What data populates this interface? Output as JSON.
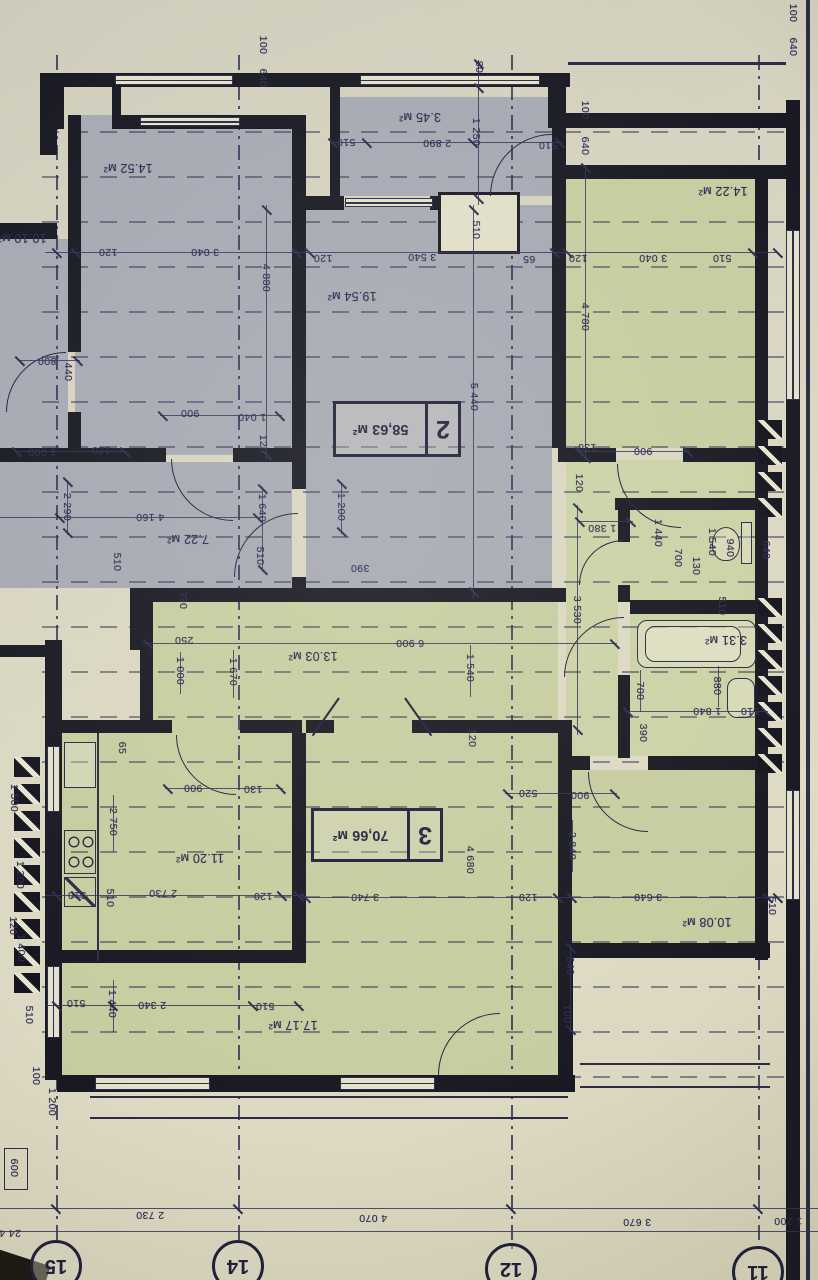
{
  "title": "apartment floor plan photo (rotated 180°)",
  "palette": {
    "paper": "#d8d5c1",
    "ink": "#2d2d52",
    "wall": "#191923",
    "gray_room": "#a7a9b3",
    "green_room": "#c7cda0"
  },
  "stamps": [
    {
      "num": "2",
      "area": "58,63 м²",
      "box": [
        333,
        401,
        122,
        50
      ]
    },
    {
      "num": "3",
      "area": "70,66 м²",
      "box": [
        311,
        808,
        126,
        48
      ]
    }
  ],
  "axes": [
    {
      "label": "15",
      "x": 56,
      "y": 1266
    },
    {
      "label": "14",
      "x": 238,
      "y": 1266
    },
    {
      "label": "12",
      "x": 511,
      "y": 1269
    },
    {
      "label": "11",
      "x": 758,
      "y": 1272
    }
  ],
  "rooms": [
    {
      "c": "gray",
      "r": [
        75,
        115,
        217,
        340
      ]
    },
    {
      "c": "gray",
      "r": [
        0,
        239,
        68,
        210
      ]
    },
    {
      "c": "gray",
      "r": [
        0,
        462,
        292,
        126
      ]
    },
    {
      "c": "gray",
      "r": [
        306,
        205,
        246,
        383
      ]
    },
    {
      "c": "gray",
      "r": [
        340,
        97,
        215,
        99
      ]
    },
    {
      "c": "green",
      "r": [
        566,
        179,
        189,
        269
      ]
    },
    {
      "c": "green2",
      "r": [
        566,
        460,
        190,
        140
      ]
    },
    {
      "c": "green2",
      "r": [
        630,
        510,
        125,
        90
      ]
    },
    {
      "c": "green2",
      "r": [
        630,
        614,
        125,
        142
      ]
    },
    {
      "c": "green",
      "r": [
        153,
        602,
        405,
        131
      ]
    },
    {
      "c": "green2",
      "r": [
        566,
        600,
        52,
        156
      ]
    },
    {
      "c": "green",
      "r": [
        62,
        733,
        230,
        217
      ]
    },
    {
      "c": "green",
      "r": [
        306,
        733,
        252,
        230
      ]
    },
    {
      "c": "green",
      "r": [
        62,
        963,
        496,
        112
      ]
    },
    {
      "c": "green",
      "r": [
        572,
        770,
        183,
        173
      ]
    }
  ],
  "walls": [
    [
      40,
      73,
      530,
      14
    ],
    [
      548,
      73,
      16,
      50
    ],
    [
      548,
      113,
      240,
      15
    ],
    [
      558,
      165,
      230,
      14
    ],
    [
      55,
      87,
      9,
      42
    ],
    [
      112,
      87,
      9,
      42
    ],
    [
      118,
      115,
      186,
      14
    ],
    [
      68,
      115,
      13,
      237
    ],
    [
      68,
      412,
      13,
      43
    ],
    [
      0,
      223,
      57,
      16
    ],
    [
      292,
      115,
      14,
      374
    ],
    [
      292,
      577,
      14,
      25
    ],
    [
      330,
      87,
      10,
      112
    ],
    [
      552,
      87,
      14,
      110
    ],
    [
      302,
      196,
      42,
      14
    ],
    [
      430,
      196,
      12,
      14
    ],
    [
      0,
      448,
      166,
      14
    ],
    [
      233,
      448,
      60,
      14
    ],
    [
      558,
      448,
      58,
      14
    ],
    [
      683,
      448,
      104,
      14
    ],
    [
      552,
      127,
      14,
      321
    ],
    [
      130,
      588,
      436,
      14
    ],
    [
      130,
      588,
      13,
      62
    ],
    [
      140,
      595,
      13,
      138
    ],
    [
      0,
      645,
      47,
      12
    ],
    [
      45,
      640,
      17,
      62
    ],
    [
      62,
      720,
      110,
      13
    ],
    [
      240,
      720,
      62,
      13
    ],
    [
      292,
      733,
      14,
      217
    ],
    [
      62,
      950,
      244,
      13
    ],
    [
      306,
      720,
      28,
      13
    ],
    [
      412,
      720,
      153,
      13
    ],
    [
      558,
      720,
      14,
      240
    ],
    [
      615,
      498,
      145,
      12
    ],
    [
      618,
      510,
      12,
      32
    ],
    [
      618,
      585,
      12,
      17
    ],
    [
      630,
      600,
      128,
      14
    ],
    [
      618,
      675,
      12,
      83
    ],
    [
      572,
      756,
      18,
      14
    ],
    [
      648,
      756,
      120,
      14
    ],
    [
      755,
      165,
      13,
      293
    ],
    [
      755,
      448,
      13,
      512
    ],
    [
      786,
      100,
      14,
      1180
    ],
    [
      57,
      1075,
      518,
      17
    ],
    [
      558,
      958,
      15,
      130
    ],
    [
      572,
      943,
      198,
      15
    ],
    [
      40,
      73,
      17,
      82
    ],
    [
      45,
      700,
      17,
      380
    ]
  ],
  "windows": [
    [
      115,
      75,
      118,
      10,
      "h"
    ],
    [
      140,
      117,
      100,
      9,
      "h"
    ],
    [
      345,
      198,
      88,
      9,
      "h"
    ],
    [
      360,
      75,
      180,
      10,
      "h"
    ],
    [
      786,
      230,
      14,
      170,
      "v"
    ],
    [
      786,
      790,
      14,
      110,
      "v"
    ],
    [
      47,
      746,
      13,
      66,
      "v"
    ],
    [
      47,
      966,
      13,
      72,
      "v"
    ],
    [
      95,
      1077,
      115,
      13,
      "h"
    ],
    [
      340,
      1077,
      95,
      13,
      "h"
    ]
  ],
  "chimney": [
    438,
    192,
    82,
    62
  ],
  "thin": [
    [
      97,
      733,
      2,
      228
    ],
    [
      568,
      62,
      218,
      3
    ],
    [
      806,
      0,
      4,
      1280
    ],
    [
      90,
      1096,
      478,
      2
    ],
    [
      90,
      1117,
      478,
      2
    ],
    [
      580,
      1063,
      190,
      2
    ],
    [
      580,
      1086,
      190,
      2
    ]
  ],
  "detail_box": [
    4,
    1148,
    24,
    42
  ],
  "vents": [
    {
      "x": 14,
      "y": 757,
      "n": 9,
      "step": 27,
      "w": 26,
      "h": 20
    },
    {
      "x": 758,
      "y": 420,
      "n": 4,
      "step": 26,
      "w": 24,
      "h": 19
    },
    {
      "x": 758,
      "y": 598,
      "n": 7,
      "step": 26,
      "w": 24,
      "h": 19
    }
  ],
  "doors": [
    [
      171,
      459,
      62,
      "bl"
    ],
    [
      6,
      352,
      60,
      "tl"
    ],
    [
      234,
      513,
      64,
      "tl"
    ],
    [
      490,
      134,
      62,
      "tl"
    ],
    [
      617,
      464,
      64,
      "bl"
    ],
    [
      176,
      735,
      60,
      "bl"
    ],
    [
      564,
      617,
      60,
      "tl"
    ],
    [
      579,
      540,
      45,
      "tl"
    ],
    [
      588,
      772,
      60,
      "bl"
    ],
    [
      438,
      1013,
      62,
      "tl"
    ]
  ],
  "leaves": [
    [
      338,
      698,
      46,
      35
    ],
    [
      404,
      698,
      46,
      -35
    ]
  ],
  "fixtures": {
    "tub": [
      637,
      620,
      119,
      48
    ],
    "tub_inner": [
      645,
      626,
      96,
      36
    ],
    "bath_sink": [
      727,
      678,
      28,
      40
    ],
    "toilet_bowl": [
      712,
      527,
      28,
      34
    ],
    "toilet_tank": [
      741,
      522,
      11,
      42
    ],
    "kitchen_sink": [
      64,
      742,
      32,
      46
    ],
    "kitchen_stove": [
      64,
      830,
      32,
      44
    ],
    "kitchen_wash": [
      64,
      877,
      32,
      30
    ]
  },
  "dimlines": [
    {
      "o": "h",
      "x": 45,
      "y": 252,
      "len": 733,
      "ticks": [
        57,
        76,
        297,
        310,
        555,
        568,
        753,
        778
      ]
    },
    {
      "o": "h",
      "x": 330,
      "y": 142,
      "len": 233,
      "ticks": [
        333,
        367,
        473,
        560
      ]
    },
    {
      "o": "v",
      "x": 478,
      "y": 60,
      "len": 145,
      "ticks": [
        64,
        88,
        199
      ]
    },
    {
      "o": "v",
      "x": 473,
      "y": 205,
      "len": 393,
      "ticks": [
        210,
        592
      ]
    },
    {
      "o": "v",
      "x": 266,
      "y": 205,
      "len": 255,
      "ticks": [
        210,
        455
      ]
    },
    {
      "o": "v",
      "x": 585,
      "y": 165,
      "len": 295,
      "ticks": [
        168,
        458
      ]
    },
    {
      "o": "h",
      "x": 18,
      "y": 360,
      "len": 62,
      "ticks": [
        20,
        78
      ]
    },
    {
      "o": "h",
      "x": 160,
      "y": 415,
      "len": 122,
      "ticks": [
        163,
        280
      ]
    },
    {
      "o": "h",
      "x": 15,
      "y": 451,
      "len": 112,
      "ticks": [
        17,
        125
      ]
    },
    {
      "o": "h",
      "x": 577,
      "y": 451,
      "len": 113,
      "ticks": [
        580,
        688
      ]
    },
    {
      "o": "h",
      "x": 0,
      "y": 517,
      "len": 262,
      "ticks": [
        60,
        258
      ]
    },
    {
      "o": "v",
      "x": 67,
      "y": 480,
      "len": 55,
      "ticks": [
        482,
        533
      ]
    },
    {
      "o": "v",
      "x": 262,
      "y": 487,
      "len": 85,
      "ticks": [
        489,
        570
      ]
    },
    {
      "o": "v",
      "x": 341,
      "y": 482,
      "len": 52,
      "ticks": [
        484,
        532
      ]
    },
    {
      "o": "v",
      "x": 577,
      "y": 505,
      "len": 230,
      "ticks": [
        508,
        730
      ]
    },
    {
      "o": "h",
      "x": 578,
      "y": 521,
      "len": 55,
      "ticks": [
        580,
        631
      ]
    },
    {
      "o": "h",
      "x": 145,
      "y": 643,
      "len": 472,
      "ticks": [
        148,
        615
      ]
    },
    {
      "o": "v",
      "x": 180,
      "y": 652,
      "len": 42,
      "ticks": []
    },
    {
      "o": "v",
      "x": 233,
      "y": 650,
      "len": 48,
      "ticks": []
    },
    {
      "o": "v",
      "x": 470,
      "y": 645,
      "len": 52,
      "ticks": []
    },
    {
      "o": "v",
      "x": 113,
      "y": 795,
      "len": 57,
      "ticks": []
    },
    {
      "o": "h",
      "x": 165,
      "y": 788,
      "len": 118,
      "ticks": [
        168,
        281
      ]
    },
    {
      "o": "h",
      "x": 45,
      "y": 895,
      "len": 257,
      "ticks": [
        57,
        76,
        282,
        299
      ]
    },
    {
      "o": "h",
      "x": 505,
      "y": 793,
      "len": 112,
      "ticks": [
        508,
        615
      ]
    },
    {
      "o": "v",
      "x": 572,
      "y": 820,
      "len": 52,
      "ticks": []
    },
    {
      "o": "h",
      "x": 300,
      "y": 897,
      "len": 478,
      "ticks": [
        306,
        558,
        572,
        768,
        778
      ]
    },
    {
      "o": "h",
      "x": 45,
      "y": 1005,
      "len": 257,
      "ticks": [
        57,
        113,
        253,
        299
      ]
    },
    {
      "o": "v",
      "x": 113,
      "y": 980,
      "len": 52,
      "ticks": []
    },
    {
      "o": "v",
      "x": 570,
      "y": 945,
      "len": 87,
      "ticks": [
        948,
        1030
      ]
    },
    {
      "o": "h",
      "x": 625,
      "y": 711,
      "len": 143,
      "ticks": [
        628,
        766
      ]
    },
    {
      "o": "v",
      "x": 640,
      "y": 670,
      "len": 42,
      "ticks": []
    },
    {
      "o": "v",
      "x": 718,
      "y": 666,
      "len": 41,
      "ticks": []
    },
    {
      "o": "h",
      "x": 0,
      "y": 1208,
      "len": 818,
      "ticks": [
        56,
        238,
        511,
        758
      ]
    },
    {
      "o": "h",
      "x": 0,
      "y": 1231,
      "len": 818,
      "ticks": []
    }
  ],
  "dash_axes": [
    [
      56,
      55,
      1190
    ],
    [
      238,
      55,
      1190
    ],
    [
      511,
      55,
      1195
    ],
    [
      758,
      55,
      1200
    ]
  ],
  "labels": [
    [
      "100",
      263,
      45,
      90
    ],
    [
      "640",
      263,
      78,
      90
    ],
    [
      "80",
      479,
      67,
      90
    ],
    [
      "3.45 м²",
      420,
      117,
      180,
      1
    ],
    [
      "510",
      346,
      142,
      180
    ],
    [
      "2 890",
      437,
      143,
      180
    ],
    [
      "1 250",
      476,
      132,
      90
    ],
    [
      "510",
      548,
      145,
      180
    ],
    [
      "100",
      585,
      110,
      90
    ],
    [
      "640",
      585,
      146,
      90
    ],
    [
      "100",
      793,
      13,
      90
    ],
    [
      "640",
      793,
      47,
      90
    ],
    [
      "14.52 м²",
      128,
      168,
      180,
      1
    ],
    [
      "10.10 м²",
      22,
      238,
      180,
      1
    ],
    [
      "19.54 м²",
      352,
      296,
      180,
      1
    ],
    [
      "14.22 м²",
      723,
      191,
      180,
      1
    ],
    [
      "120",
      108,
      252,
      180
    ],
    [
      "3 040",
      205,
      252,
      180
    ],
    [
      "120",
      323,
      258,
      180
    ],
    [
      "3 540",
      422,
      257,
      180
    ],
    [
      "65",
      529,
      259,
      180
    ],
    [
      "120",
      578,
      258,
      180
    ],
    [
      "3 040",
      653,
      258,
      180
    ],
    [
      "510",
      722,
      258,
      180
    ],
    [
      "4 880",
      266,
      278,
      90
    ],
    [
      "510",
      476,
      230,
      90
    ],
    [
      "5 440",
      474,
      397,
      90
    ],
    [
      "4 780",
      585,
      317,
      90
    ],
    [
      "800",
      47,
      361,
      180
    ],
    [
      "440",
      68,
      372,
      90
    ],
    [
      "900",
      190,
      413,
      180
    ],
    [
      "1 040",
      252,
      417,
      180
    ],
    [
      "120",
      263,
      444,
      90
    ],
    [
      "1 000",
      42,
      452,
      180
    ],
    [
      "120",
      101,
      450,
      180
    ],
    [
      "2 290",
      67,
      507,
      90
    ],
    [
      "4 160",
      150,
      517,
      180
    ],
    [
      "1 640",
      262,
      508,
      90
    ],
    [
      "510",
      260,
      556,
      90
    ],
    [
      "510",
      117,
      562,
      90
    ],
    [
      "390",
      183,
      600,
      90
    ],
    [
      "7.22 м²",
      188,
      539,
      180,
      1
    ],
    [
      "1 200",
      341,
      507,
      90
    ],
    [
      "390",
      360,
      568,
      180
    ],
    [
      "130",
      587,
      447,
      180
    ],
    [
      "900",
      643,
      451,
      180
    ],
    [
      "120",
      579,
      483,
      90
    ],
    [
      "1 380",
      602,
      528,
      180
    ],
    [
      "1 440",
      658,
      533,
      90
    ],
    [
      "700",
      678,
      558,
      90
    ],
    [
      "130",
      696,
      566,
      90
    ],
    [
      "1 540",
      712,
      542,
      90
    ],
    [
      "940",
      730,
      548,
      90
    ],
    [
      "510",
      722,
      606,
      90
    ],
    [
      "640",
      766,
      550,
      90
    ],
    [
      "3 530",
      577,
      610,
      90
    ],
    [
      "250",
      184,
      640,
      180
    ],
    [
      "6 900",
      410,
      643,
      180
    ],
    [
      "13.03 м²",
      313,
      656,
      180,
      1
    ],
    [
      "1 000",
      180,
      671,
      90
    ],
    [
      "1 670",
      233,
      672,
      90
    ],
    [
      "1 540",
      470,
      668,
      90
    ],
    [
      "120",
      472,
      738,
      90
    ],
    [
      "3.31 м²",
      726,
      640,
      180,
      1
    ],
    [
      "700",
      640,
      691,
      90
    ],
    [
      "880",
      717,
      686,
      90
    ],
    [
      "390",
      643,
      733,
      90
    ],
    [
      "1 840",
      707,
      711,
      180
    ],
    [
      "510",
      750,
      711,
      180
    ],
    [
      "65",
      122,
      748,
      90
    ],
    [
      "900",
      193,
      788,
      180
    ],
    [
      "130",
      253,
      789,
      180
    ],
    [
      "2 750",
      113,
      822,
      90
    ],
    [
      "11.20 м²",
      200,
      858,
      180,
      1
    ],
    [
      "520",
      528,
      793,
      180
    ],
    [
      "900",
      580,
      795,
      180
    ],
    [
      "2 840",
      572,
      846,
      90
    ],
    [
      "510",
      77,
      895,
      180
    ],
    [
      "510",
      110,
      898,
      90
    ],
    [
      "2 730",
      163,
      893,
      180
    ],
    [
      "120",
      263,
      896,
      180
    ],
    [
      "3 740",
      365,
      897,
      180
    ],
    [
      "4 680",
      470,
      860,
      90
    ],
    [
      "120",
      528,
      897,
      180
    ],
    [
      "3 640",
      648,
      897,
      180
    ],
    [
      "510",
      772,
      906,
      90
    ],
    [
      "10.08 м²",
      707,
      922,
      180,
      1
    ],
    [
      "510",
      76,
      1003,
      180
    ],
    [
      "2 340",
      152,
      1005,
      180
    ],
    [
      "1 440",
      112,
      1004,
      90
    ],
    [
      "510",
      265,
      1006,
      180
    ],
    [
      "17.17 м²",
      293,
      1025,
      180,
      1
    ],
    [
      "640",
      570,
      966,
      90
    ],
    [
      "100",
      567,
      1014,
      90
    ],
    [
      "1 500",
      14,
      798,
      90
    ],
    [
      "1 200",
      20,
      875,
      90
    ],
    [
      "120",
      13,
      926,
      90
    ],
    [
      "1 400",
      21,
      948,
      90
    ],
    [
      "510",
      29,
      1015,
      90
    ],
    [
      "100",
      36,
      1076,
      90
    ],
    [
      "1 200",
      52,
      1102,
      90
    ],
    [
      "600",
      14,
      1168,
      90
    ],
    [
      "2 730",
      150,
      1215,
      180
    ],
    [
      "4 070",
      373,
      1218,
      180
    ],
    [
      "3 670",
      637,
      1222,
      180
    ],
    [
      "1 200",
      788,
      1221,
      180
    ],
    [
      "24 4",
      10,
      1233,
      180
    ]
  ]
}
